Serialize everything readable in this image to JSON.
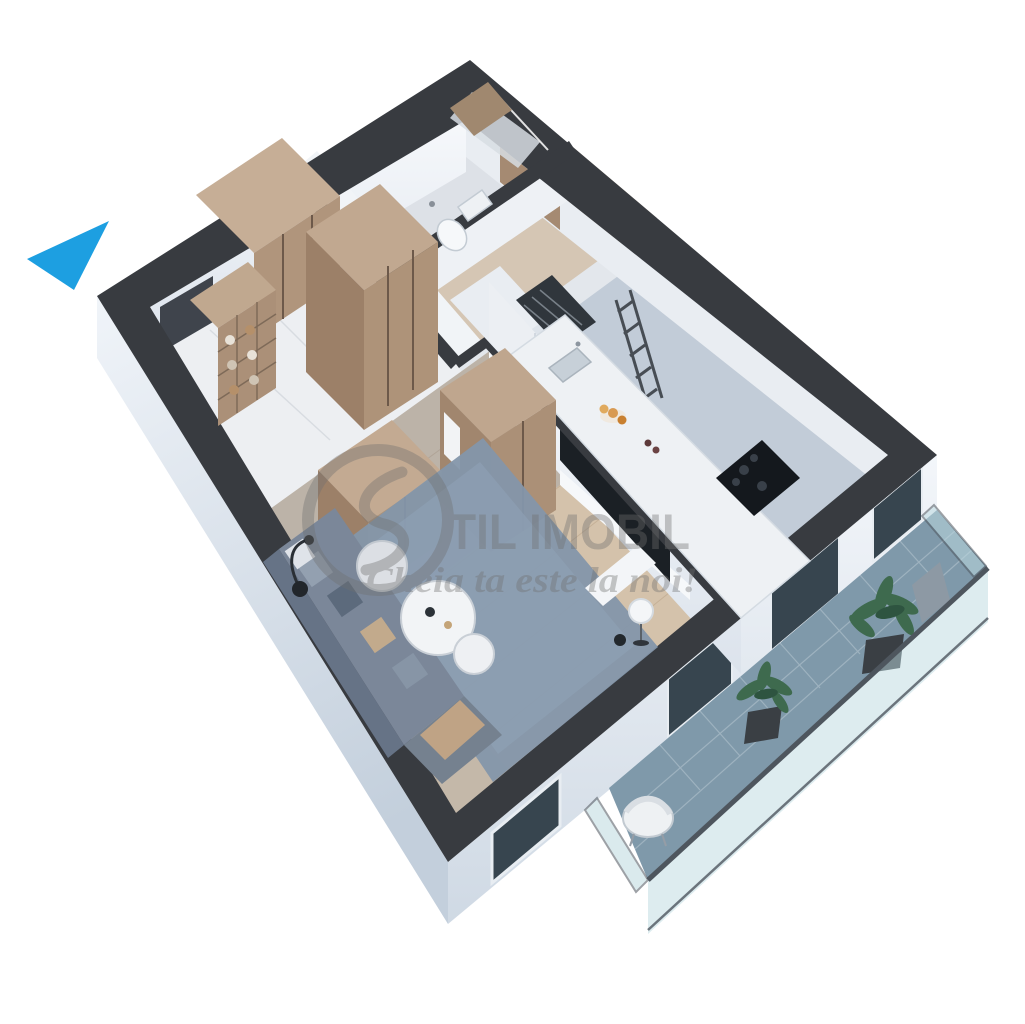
{
  "canvas": {
    "width": 1025,
    "height": 1024,
    "background": "#ffffff"
  },
  "watermark": {
    "brand_text": "TIL IMOBIL",
    "logo_shape": "S-monogram-ring",
    "tagline": "Cheia ta este la noi!",
    "color": "#707070",
    "opacity": 0.38
  },
  "entrance_arrow": {
    "color": "#1d9fe1"
  },
  "palette": {
    "wall_top": "#383b40",
    "wall_face": "#dde5ee",
    "wall_face_inner": "#f1f4f8",
    "marble_floor": "#edeff2",
    "wood_floor": "#d4c2ab",
    "storage_floor": "#d5c6b4",
    "kitchen_floor": "#c2ccd8",
    "bathroom_floor": "#dde1e7",
    "rug": "#8496aa",
    "sofa": "#7b8799",
    "wood_furniture": "#ae9379",
    "counter": "#eef1f4",
    "tv_screen": "#1b2025",
    "balcony_tile": "#7f99aa",
    "glass": "#bcd9e0",
    "plant": "#3e6a4e",
    "window_glass": "#37454f"
  },
  "rooms": [
    {
      "name": "hallway",
      "items": [
        "entrance-door",
        "wardrobe",
        "open-shelf-unit",
        "marble-floor"
      ]
    },
    {
      "name": "bathroom",
      "items": [
        "towel-radiator",
        "toilet",
        "shower",
        "wood-accent-panel"
      ]
    },
    {
      "name": "storage-niche",
      "items": [
        "white-cabinet",
        "dark-shelf-rack",
        "ladder-shelf"
      ]
    },
    {
      "name": "kitchen",
      "items": [
        "counter",
        "sink",
        "cooktop",
        "fruits",
        "tall-cabinets"
      ]
    },
    {
      "name": "living-room",
      "items": [
        "sofa",
        "cushions",
        "rug",
        "coffee-table",
        "side-table",
        "pouf",
        "floor-lamp",
        "tv-panel",
        "sphere-lamp",
        "console"
      ]
    },
    {
      "name": "balcony",
      "items": [
        "tile-floor",
        "glass-balustrade",
        "potted-plant",
        "potted-plant",
        "outdoor-chair"
      ]
    }
  ]
}
